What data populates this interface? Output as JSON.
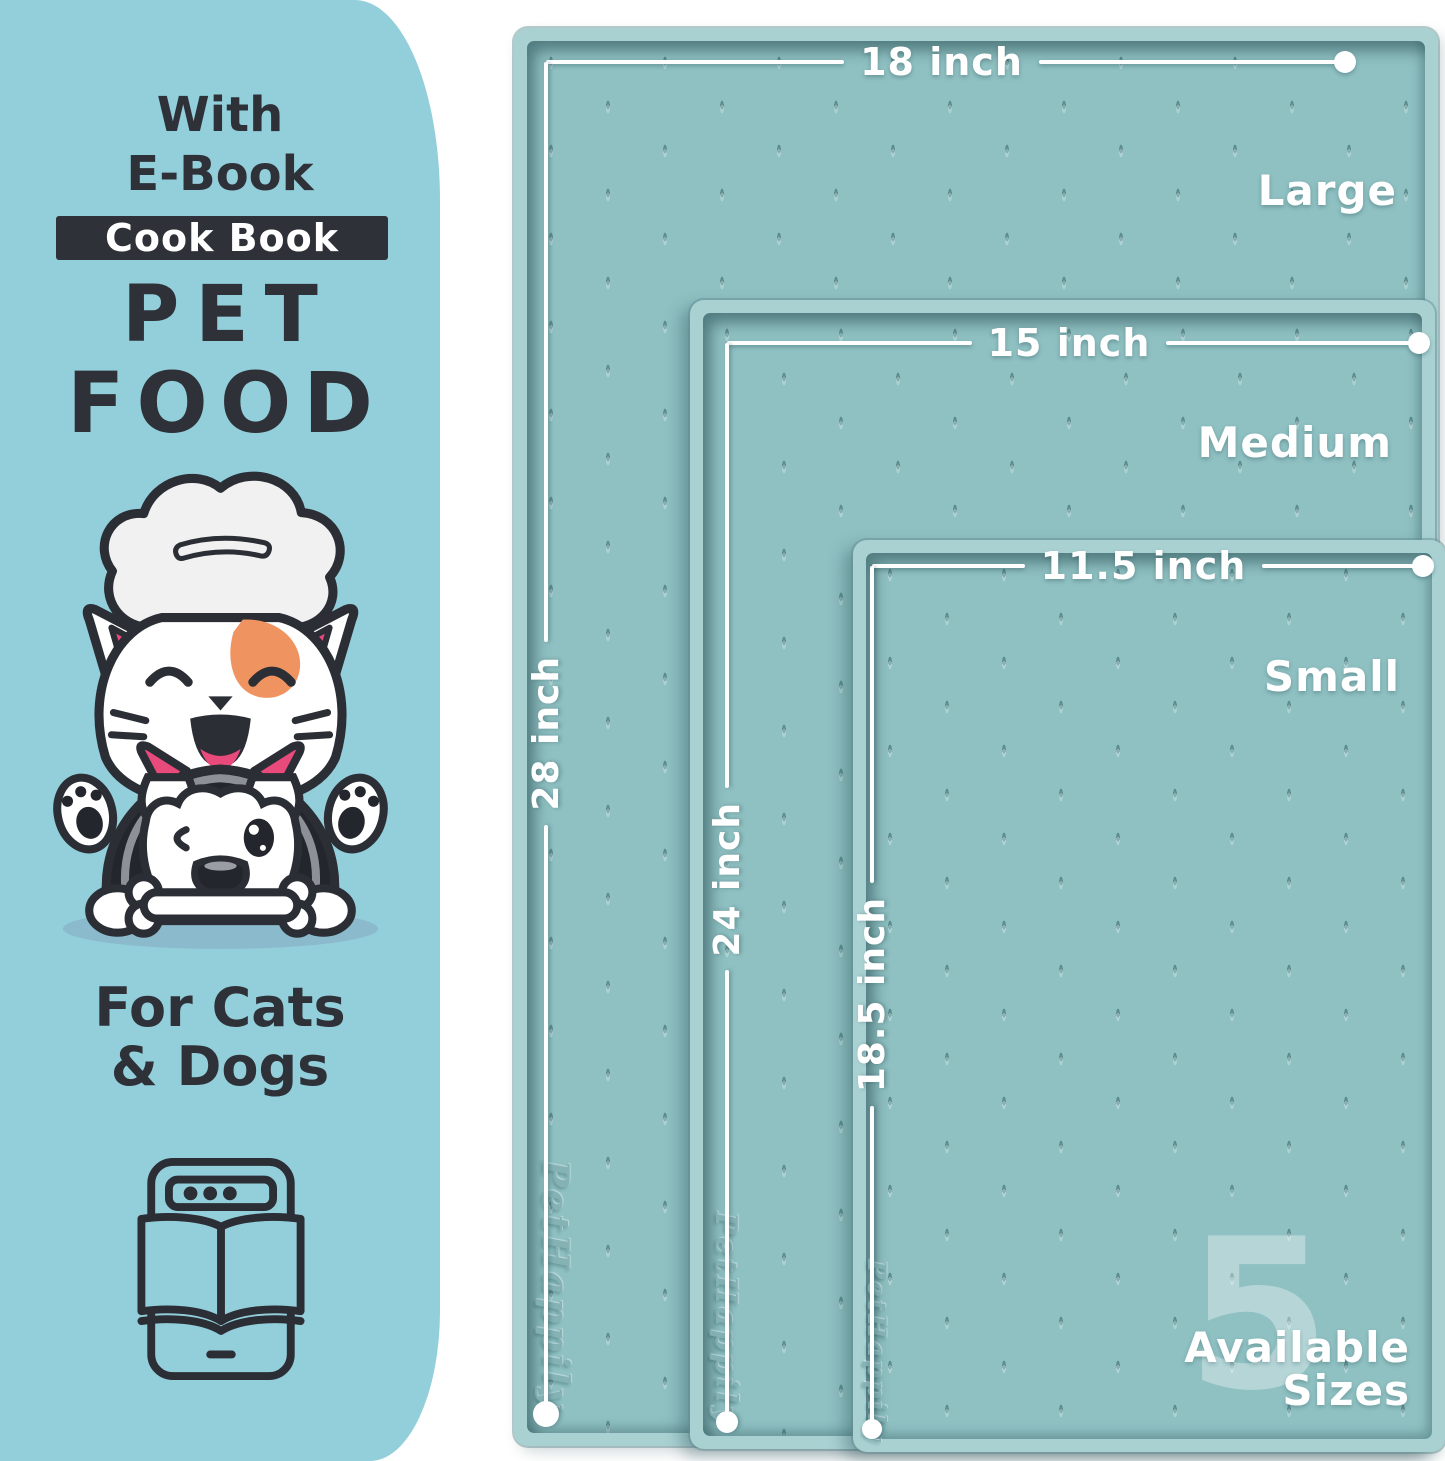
{
  "panel": {
    "with_line": "With",
    "ebook_line": "E-Book",
    "badge": "Cook Book",
    "title_line1": "PET",
    "title_line2": "FOOD",
    "for_line1": "For Cats",
    "for_line2": "& Dogs"
  },
  "mats": [
    {
      "size_name": "Large",
      "width_label": "18 inch",
      "length_label": "28 inch",
      "brand": "PetHappily"
    },
    {
      "size_name": "Medium",
      "width_label": "15 inch",
      "length_label": "24 inch",
      "brand": "PetHappily"
    },
    {
      "size_name": "Small",
      "width_label": "11.5 inch",
      "length_label": "18.5 inch",
      "brand": "PetHappily"
    }
  ],
  "sizes_badge": {
    "number": "5",
    "label_line1": "Available",
    "label_line2": "Sizes"
  },
  "colors": {
    "panel_bg": "#93cedb",
    "mat_surface": "#8fc0c2",
    "mat_rim": "#a9d1d2",
    "accent_dark": "#2e3238",
    "patch_orange": "#ef9461",
    "pink": "#e84a7b",
    "white": "#ffffff"
  }
}
